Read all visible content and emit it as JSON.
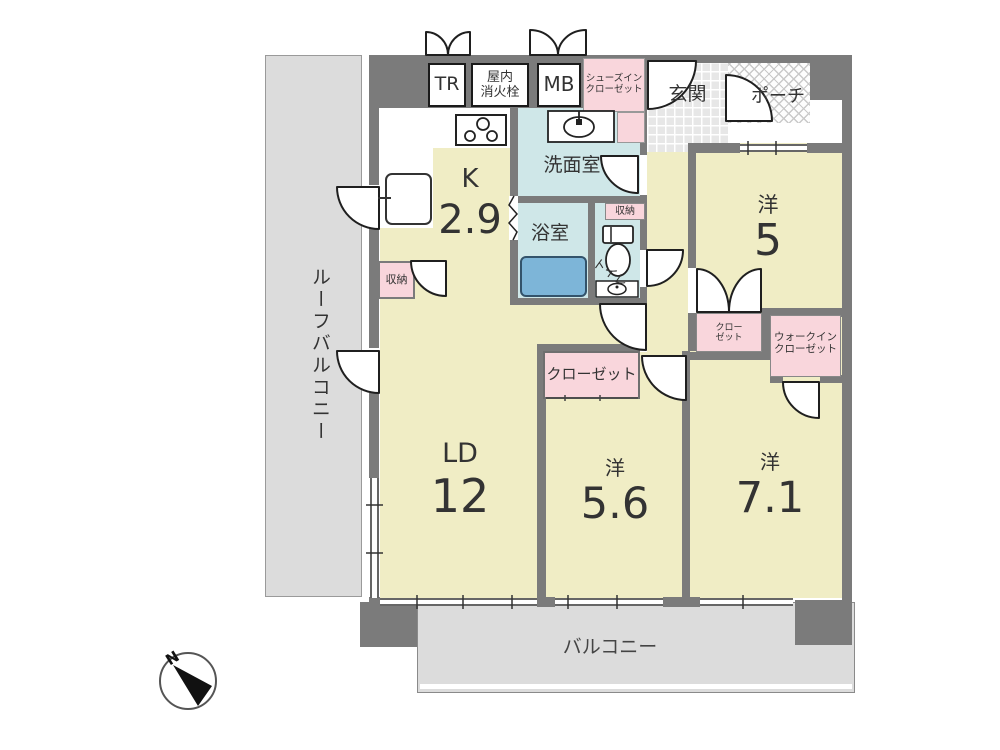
{
  "floorplan": {
    "outdoor": {
      "roof_balcony": "ルーフバルコニー",
      "balcony": "バルコニー",
      "porch": "ポーチ"
    },
    "entry": {
      "genkan": "玄関",
      "shoes_closet_line1": "シューズイン",
      "shoes_closet_line2": "クローゼット"
    },
    "service": {
      "trunk_room": "TR",
      "fire_hydrant_line1": "屋内",
      "fire_hydrant_line2": "消火栓",
      "meter_box": "MB"
    },
    "kitchen": {
      "label": "K",
      "size": "2.9",
      "storage": "収納"
    },
    "living": {
      "label": "LD",
      "size": "12"
    },
    "washroom": "洗面室",
    "bath": "浴室",
    "toilet": {
      "label": "トイレ",
      "storage": "収納"
    },
    "bedroom5": {
      "label": "洋",
      "size": "5",
      "closet_line1": "クロー",
      "closet_line2": "ゼット",
      "wic_line1": "ウォークイン",
      "wic_line2": "クローゼット"
    },
    "bedroom56": {
      "label": "洋",
      "size": "5.6",
      "closet": "クローゼット"
    },
    "bedroom71": {
      "label": "洋",
      "size": "7.1"
    },
    "compass": {
      "north": "N"
    },
    "colors": {
      "room_floor": "#f0edc5",
      "wet_floor": "#cfe7e8",
      "closet_pink": "#f9d6dc",
      "wall": "#7b7b7b",
      "outdoor_gray": "#dcdcdc",
      "bathtub": "#7db5d8"
    }
  }
}
